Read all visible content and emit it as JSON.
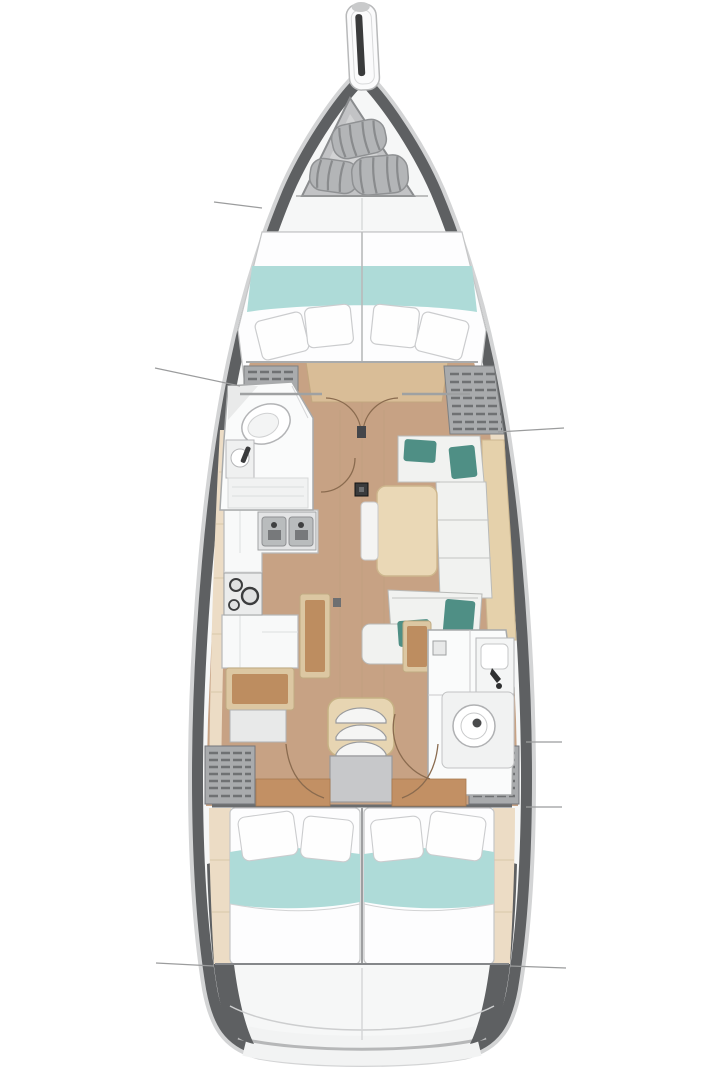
{
  "plan": {
    "kind": "sailboat-interior-floor-plan",
    "orientation": "bow-up",
    "visible_counts": {
      "bow_rolled_sails": 3,
      "v_berth_pillows": 4,
      "galley_sinks": 2,
      "stove_burners": 3,
      "companionway_steps": 3,
      "aft_double_beds": 2,
      "heads_bathrooms": 2,
      "section_reference_lines": 6
    },
    "areas": [
      "bowsprit",
      "bow-sail-locker",
      "v-berth-forward-cabin",
      "forward-head",
      "salon",
      "galley",
      "dinette-settee",
      "folding-table",
      "nav-benches",
      "companionway-steps",
      "aft-head",
      "aft-cabin-port-bed",
      "aft-cabin-starboard-bed",
      "stern-transom"
    ]
  },
  "colors": {
    "background": "#ffffff",
    "hull_band": "#5e6062",
    "hull_outer": "#d3d4d5",
    "deck": "#f6f7f7",
    "wood_floor": "#c7a284",
    "wood_mid": "#d9bd97",
    "wood_light": "#ead8b6",
    "shelf_wood": "#e5d1ab",
    "side_deck": "#ecdcc5",
    "teal_light": "#aedbd8",
    "teal_dark": "#4f8f85",
    "cushion": "#f1f2f0",
    "bedding": "#fdfdfe",
    "bench_brown": "#bd8d60",
    "bench_frame": "#dcc7a2",
    "locker_gray": "#a9abad",
    "locker_slat": "#6f7173",
    "head_white": "#fafbfb",
    "platform_gray": "#c7c8ca",
    "stair_frame": "#e7d5b2",
    "metal": "#b9bcbd",
    "metal_dark": "#8f9193",
    "line_gray": "#9b9c9d",
    "door_arc": "#8a6b4f",
    "dark": "#3a3b3c",
    "bulkhead": "#6b6d6f",
    "locker_panel": "#c2c3c5",
    "roll_gray": "#b3b5b7"
  }
}
